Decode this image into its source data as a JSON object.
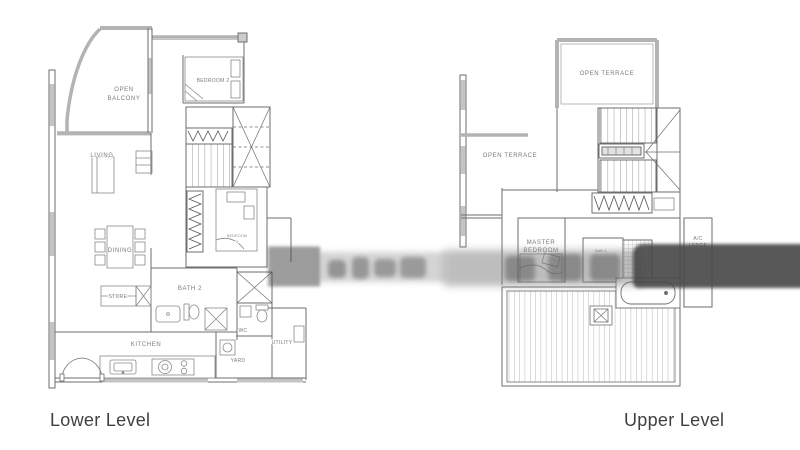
{
  "image": {
    "width": 800,
    "height": 450,
    "background": "#ffffff"
  },
  "colors": {
    "wall_gray": "#b3b3b3",
    "line_gray": "#6e6e6e",
    "label_gray": "#7a7a7a",
    "caption_gray": "#404040",
    "watermark_dark": "#474747"
  },
  "lower_plan": {
    "caption": "Lower Level",
    "labels": {
      "open_balcony_line1": "OPEN",
      "open_balcony_line2": "BALCONY",
      "bedroom2": "BEDROOM 2",
      "living": "LIVING",
      "dining": "DINING",
      "store": "STORE",
      "bath2": "BATH 2",
      "bedroom3_line1": "BEDROOM",
      "bedroom3_line2": "3",
      "kitchen": "KITCHEN",
      "wc": "WC",
      "yard": "YARD",
      "utility": "UTILITY"
    }
  },
  "upper_plan": {
    "caption": "Upper Level",
    "labels": {
      "open_terrace_top": "OPEN TERRACE",
      "open_terrace_side": "OPEN TERRACE",
      "master_line1": "MASTER",
      "master_line2": "BEDROOM",
      "bath1": "Bath 1",
      "ledge_line1": "A/C",
      "ledge_line2": "LEDGE"
    }
  }
}
